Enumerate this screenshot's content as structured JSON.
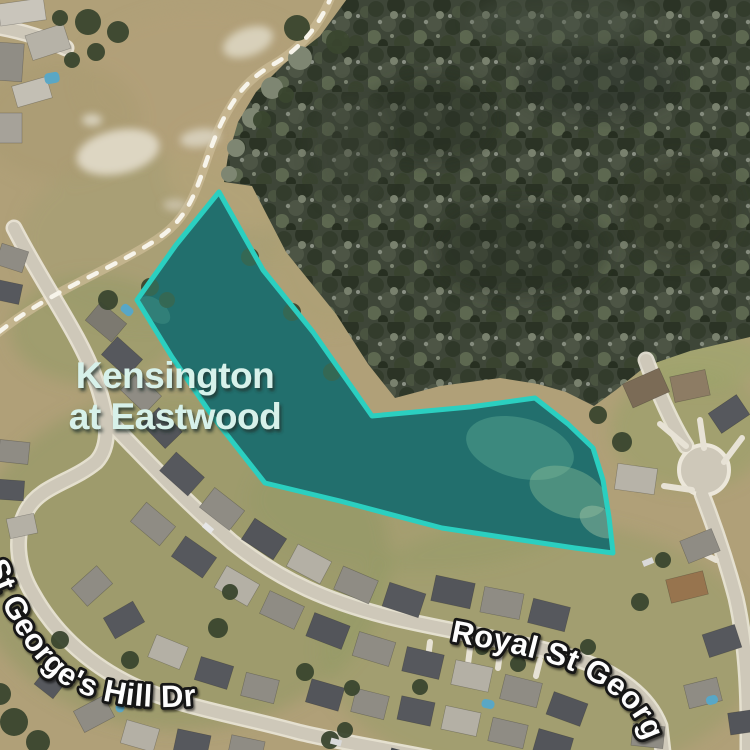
{
  "map": {
    "view": "satellite",
    "place_label": {
      "line1": "Kensington",
      "line2": "at Eastwood",
      "color": "#d7f1ea"
    },
    "street_labels": {
      "royal": "Royal St George Dr",
      "hill": "St George's Hill Dr",
      "color": "#fdfdfd",
      "outline_color": "#141414"
    },
    "region_overlay": {
      "label": "Kensington at Eastwood boundary",
      "stroke_color": "#2bcfc0",
      "fill_color": "rgba(42,205,190,0.26)",
      "points": "219,192 263,270 313,332 372,416 470,407 535,398 568,424 593,448 603,480 609,517 613,553 575,548 508,538 442,528 340,501 265,483 213,417 172,357 137,300 176,245"
    },
    "lake": {
      "color": "#1f4f52"
    }
  }
}
